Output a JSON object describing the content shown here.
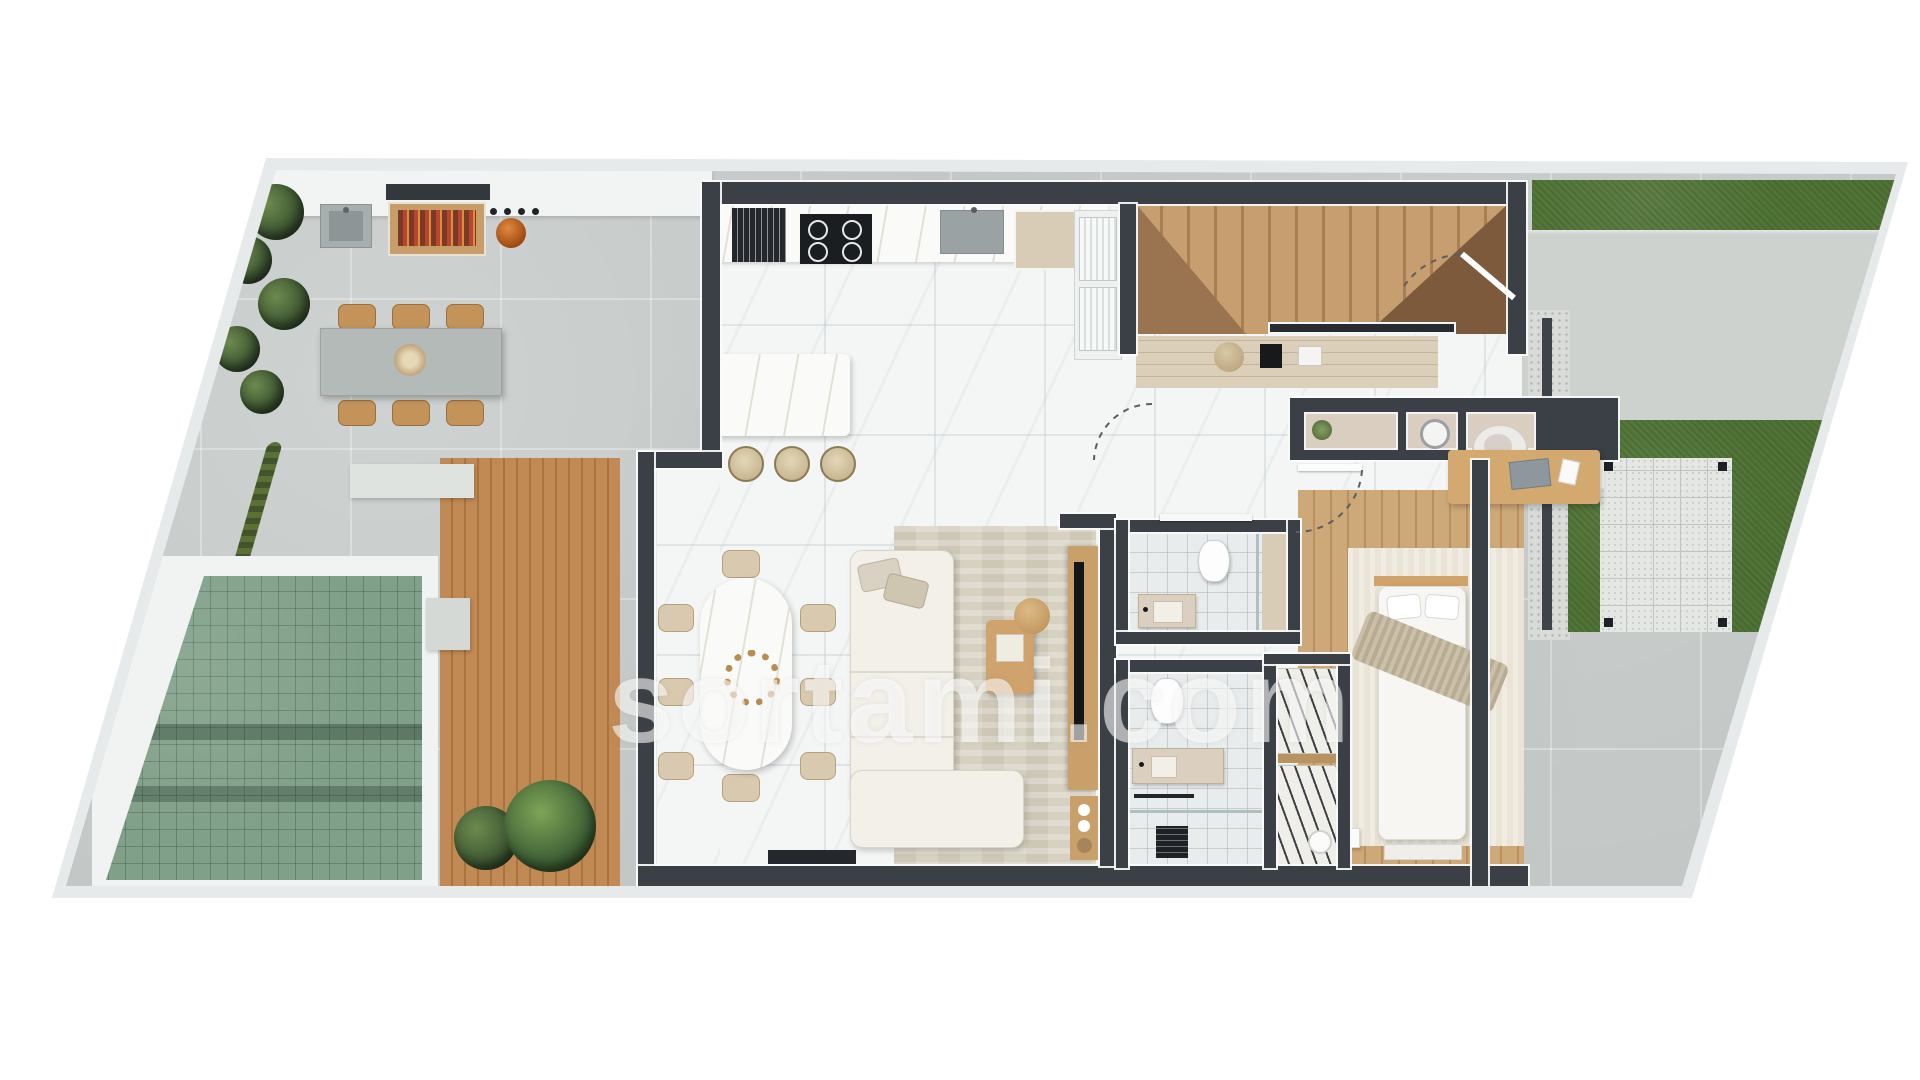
{
  "watermark": {
    "text": "sortami.com"
  },
  "plan": {
    "type": "residential-floor-plan-render",
    "view": "top-down",
    "outdoor_features": [
      "concrete-terrace",
      "outdoor-kitchen-bbq",
      "outdoor-sink",
      "outdoor-dining-table",
      "planting-border",
      "terraced-green-lawn",
      "timber-deck",
      "deck-plants",
      "gravel-drain",
      "driveway",
      "grass-strips",
      "pergola-patio"
    ],
    "indoor_features": [
      "kitchen-counter",
      "oven",
      "cooktop",
      "kitchen-sink",
      "tall-cabinets",
      "kitchen-island",
      "bar-stools",
      "staircase",
      "entry-bench",
      "hallway-niche-shelves",
      "washing-machine",
      "dining-table",
      "dining-chairs",
      "l-shaped-sofa",
      "area-rug",
      "coffee-table",
      "tv-unit",
      "guest-bathroom",
      "ensuite-bathroom",
      "shower",
      "wardrobes",
      "bedroom",
      "double-bed",
      "desk",
      "desk-chair"
    ],
    "colors": {
      "wall": "#3a4046",
      "concrete": "#c2c7c5",
      "lawn_tiles": "#81a089",
      "grass": "#507436",
      "deck_wood": "#c08a55",
      "interior_floor": "#f4f6f6",
      "bedroom_wood": "#cda878",
      "travertine": "#dccfb9",
      "accent_wood": "#cfa36b"
    }
  }
}
